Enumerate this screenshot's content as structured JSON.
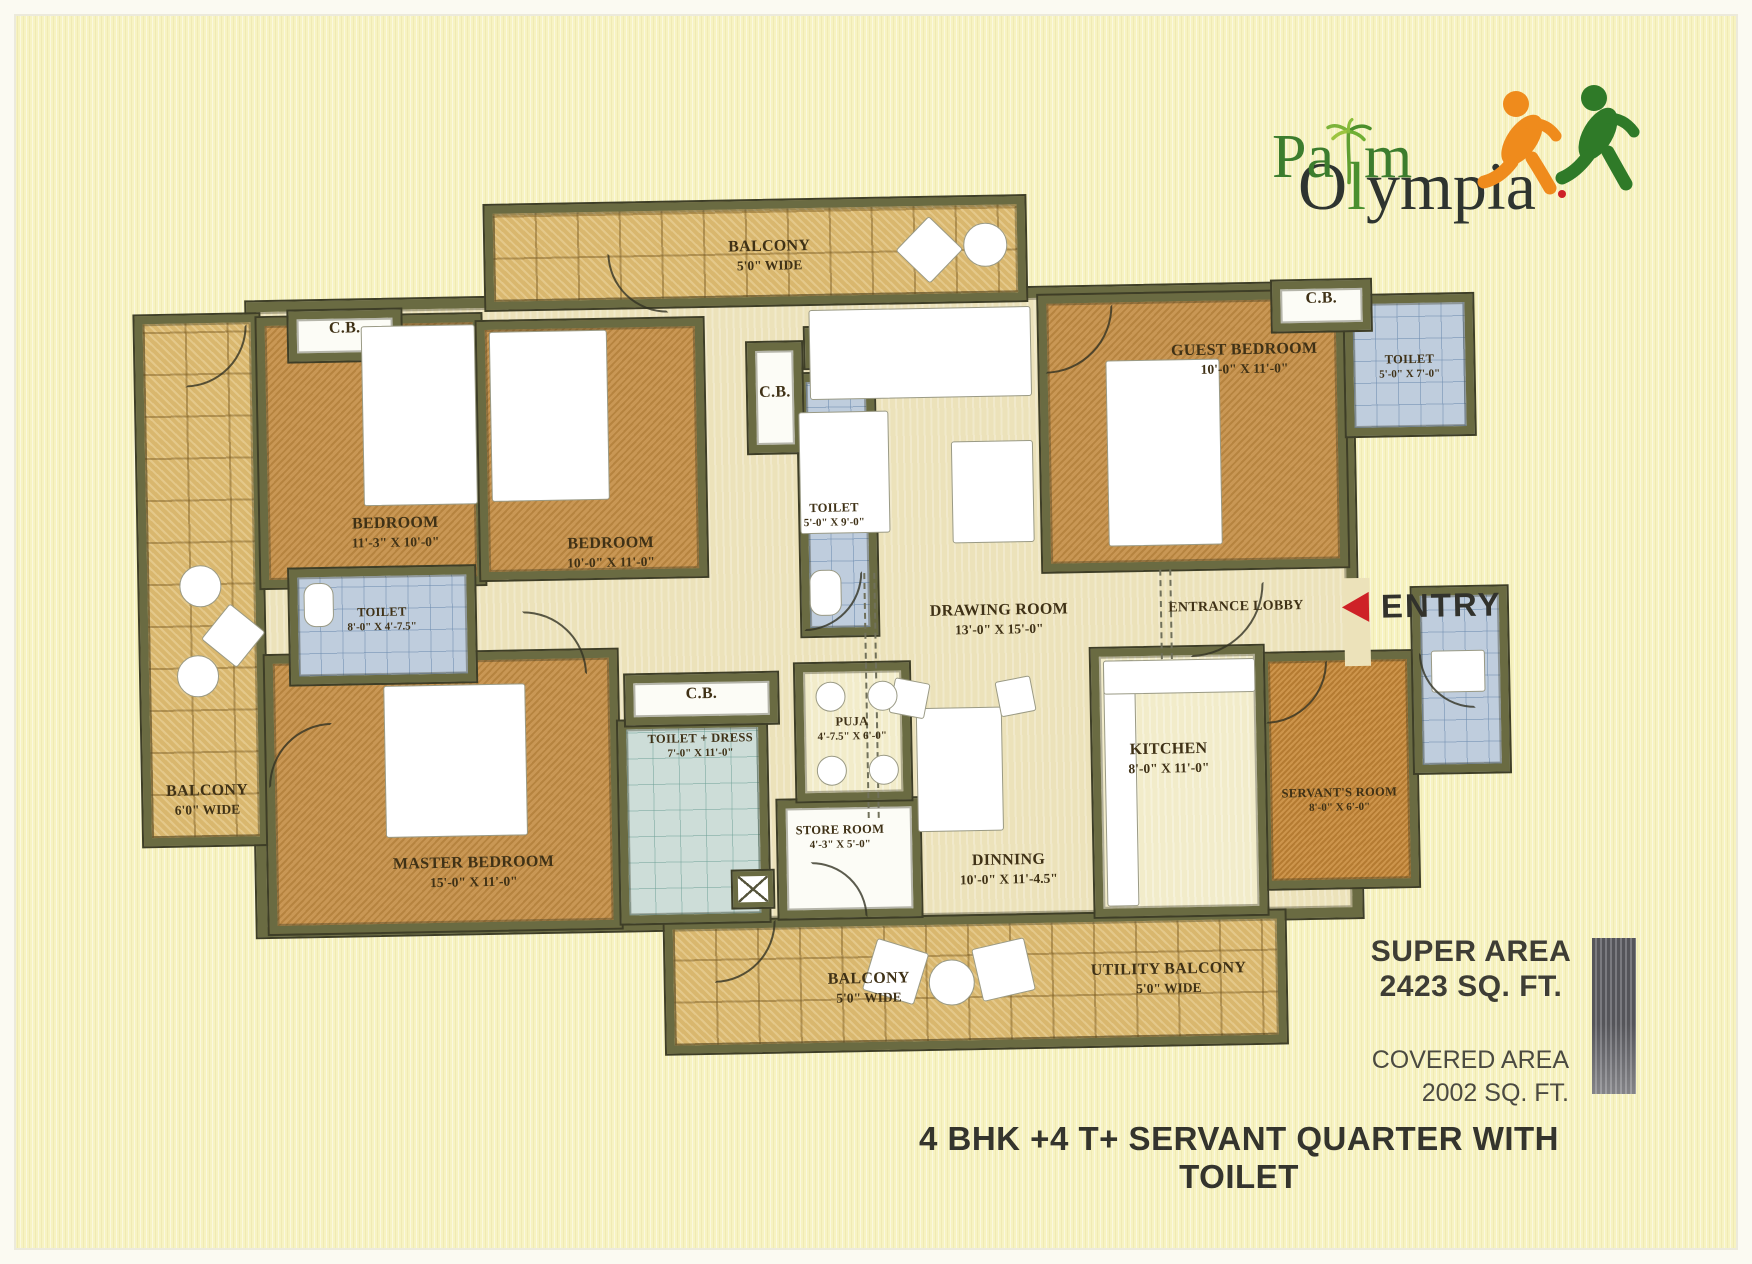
{
  "logo": {
    "word1": "Palm",
    "word2_o": "O",
    "word2_l": "l",
    "word2_rest": "ympia"
  },
  "plan": {
    "balcony_top": {
      "name": "BALCONY",
      "dims": "5'0\" WIDE"
    },
    "cb_left": {
      "name": "C.B."
    },
    "bedroom_left": {
      "name": "BEDROOM",
      "dims": "11'-3\" X 10'-0\""
    },
    "bedroom_mid": {
      "name": "BEDROOM",
      "dims": "10'-0\" X 11'-0\""
    },
    "cb_mid": {
      "name": "C.B."
    },
    "toilet_mid": {
      "name": "TOILET",
      "dims": "5'-0\" X 9'-0\""
    },
    "guest_bedroom": {
      "name": "GUEST BEDROOM",
      "dims": "10'-0\" X 11'-0\""
    },
    "cb_right": {
      "name": "C.B."
    },
    "toilet_right": {
      "name": "TOILET",
      "dims": "5'-0\" X 7'-0\""
    },
    "toilet_left": {
      "name": "TOILET",
      "dims": "8'-0\" X 4'-7.5\""
    },
    "balcony_left": {
      "name": "BALCONY",
      "dims": "6'0\" WIDE"
    },
    "master_bedroom": {
      "name": "MASTER BEDROOM",
      "dims": "15'-0\" X 11'-0\""
    },
    "cb_master": {
      "name": "C.B."
    },
    "toilet_dress": {
      "name": "TOILET + DRESS",
      "dims": "7'-0\" X 11'-0\""
    },
    "puja": {
      "name": "PUJA",
      "dims": "4'-7.5\" X 6'-0\""
    },
    "drawing_room": {
      "name": "DRAWING ROOM",
      "dims": "13'-0\" X 15'-0\""
    },
    "entrance_lobby": {
      "name": "ENTRANCE LOBBY"
    },
    "entry": {
      "label": "ENTRY"
    },
    "kitchen": {
      "name": "KITCHEN",
      "dims": "8'-0\" X 11'-0\""
    },
    "servant_room": {
      "name": "SERVANT'S ROOM",
      "dims": "8'-0\" X 6'-0\""
    },
    "store_room": {
      "name": "STORE ROOM",
      "dims": "4'-3\" X 5'-0\""
    },
    "dinning": {
      "name": "DINNING",
      "dims": "10'-0\" X 11'-4.5\""
    },
    "balcony_bottom": {
      "name": "BALCONY",
      "dims": "5'0\" WIDE"
    },
    "utility_balcony": {
      "name": "UTILITY BALCONY",
      "dims": "5'0\" WIDE"
    }
  },
  "info": {
    "super_area_label": "SUPER AREA",
    "super_area_value": "2423 SQ. FT.",
    "covered_area_label": "COVERED AREA",
    "covered_area_value": "2002 SQ. FT.",
    "headline": "4 BHK +4 T+ SERVANT QUARTER WITH TOILET"
  },
  "colors": {
    "background": "#f7f3c2",
    "wall_olive": "#6a6b42",
    "room_tan": "#c6914a",
    "balcony_tile": "#d9b76e",
    "toilet_blue": "#bfcddd",
    "floor_cream": "#ece2ba",
    "entry_arrow_red": "#ce2127",
    "logo_green": "#3c7d2e",
    "logo_dark": "#2e3430",
    "runner_orange": "#ef8b1c",
    "runner_green": "#2f7a28"
  }
}
